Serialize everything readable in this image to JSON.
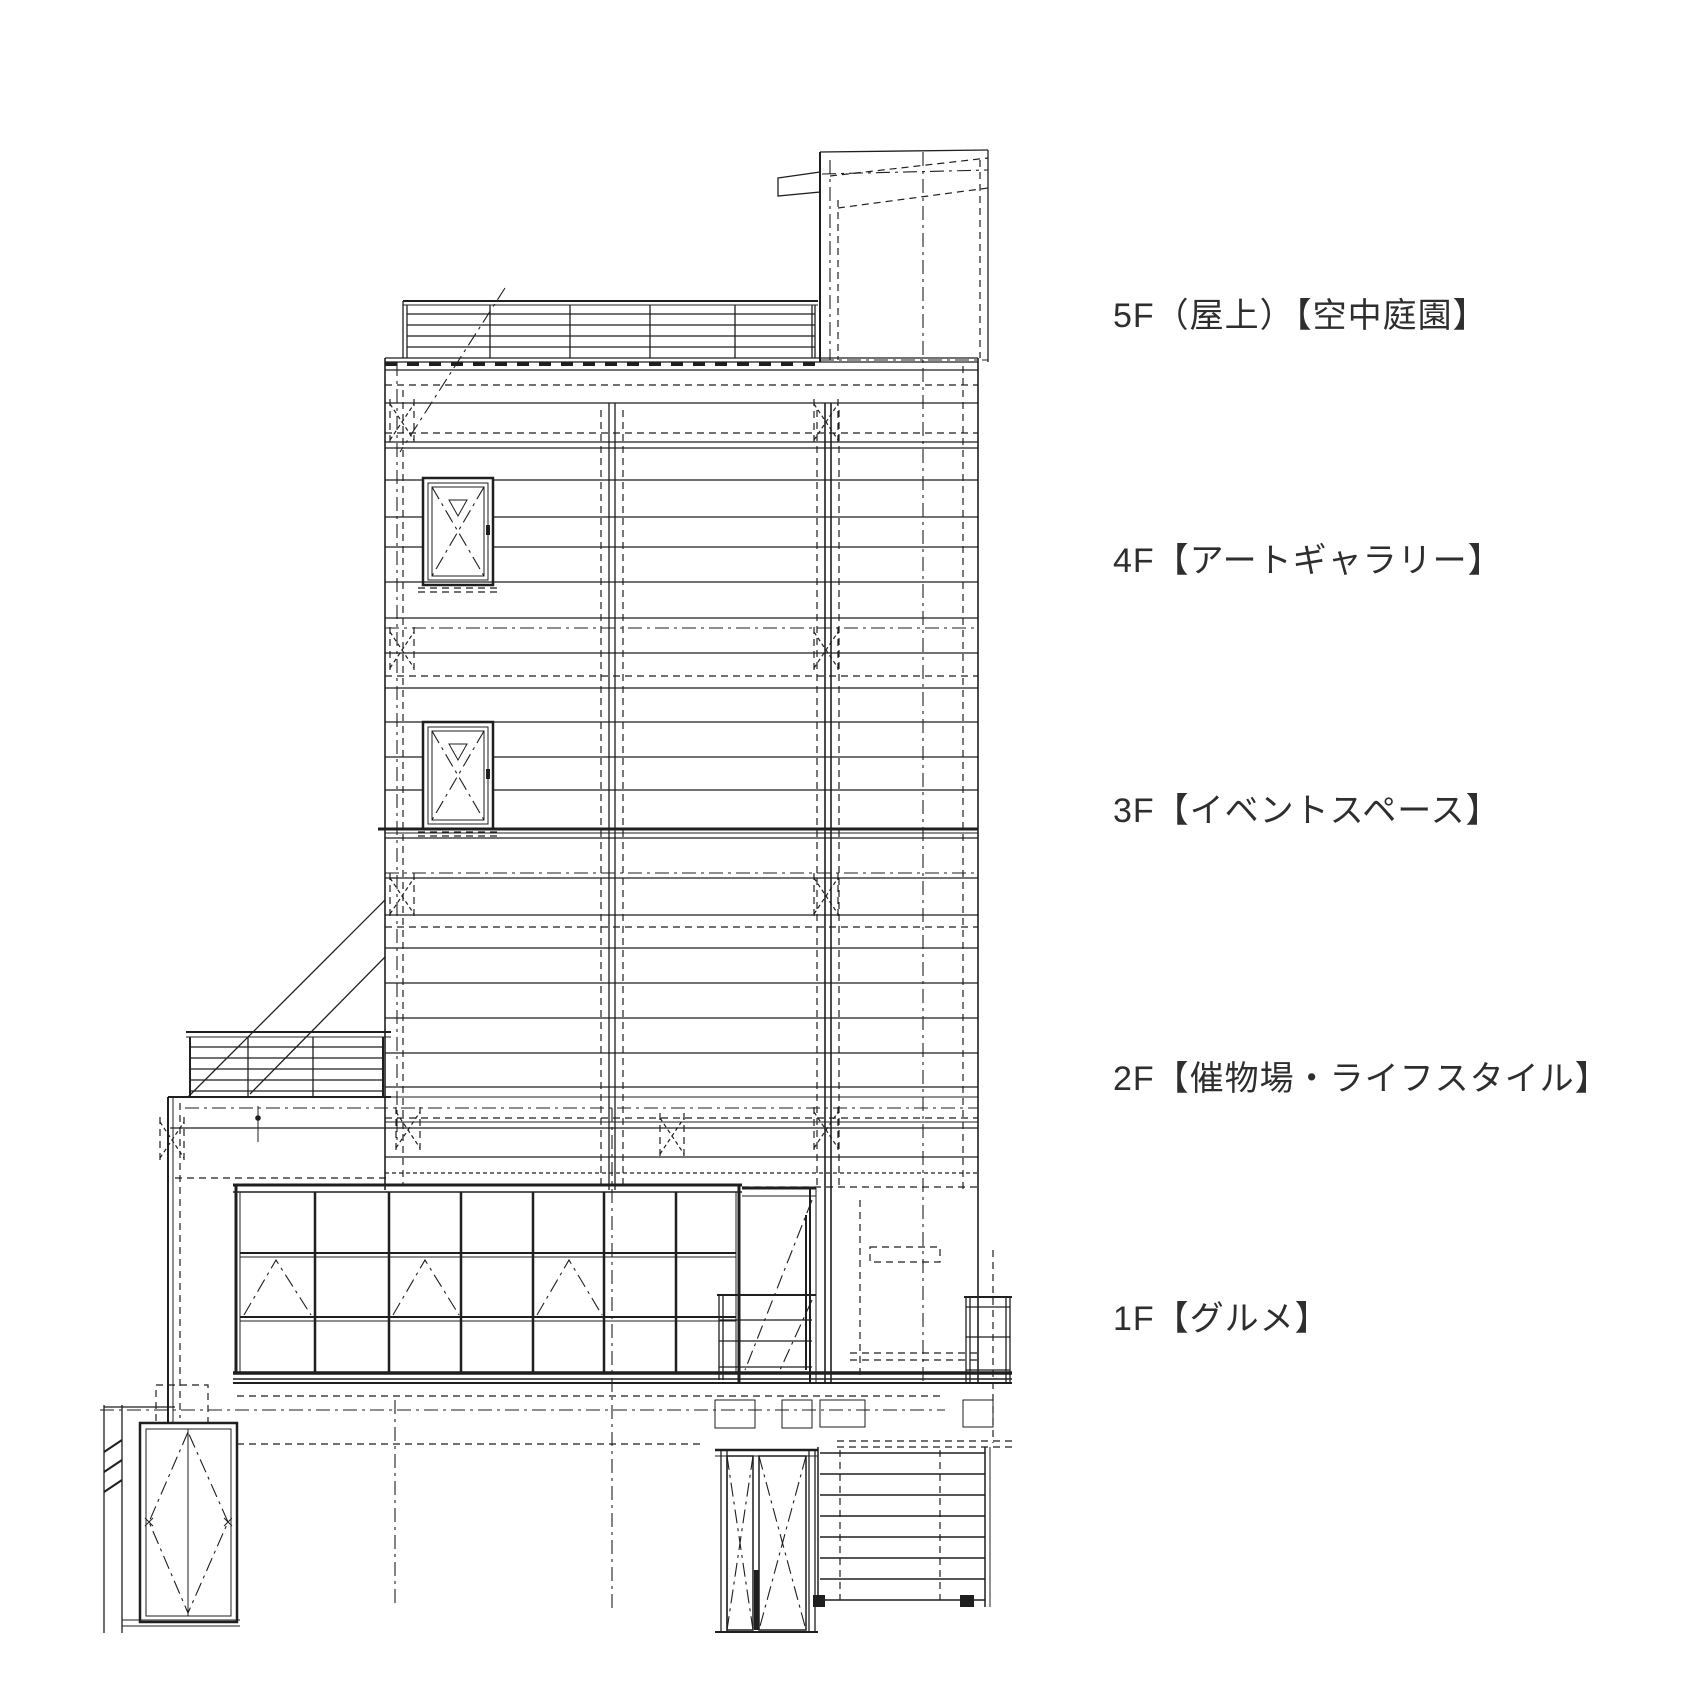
{
  "drawing": {
    "title": "建物立面図（フロア構成）",
    "type": "building-elevation",
    "line_color": "#1f1f1f",
    "background": "#ffffff",
    "floors": [
      {
        "level": "5F",
        "label": "5F（屋上）【空中庭園】",
        "zone": "空中庭園"
      },
      {
        "level": "4F",
        "label": "4F【アートギャラリー】",
        "zone": "アートギャラリー"
      },
      {
        "level": "3F",
        "label": "3F【イベントスペース】",
        "zone": "イベントスペース"
      },
      {
        "level": "2F",
        "label": "2F【催物場・ライフスタイル】",
        "zone": "催物場・ライフスタイル"
      },
      {
        "level": "1F",
        "label": "1F【グルメ】",
        "zone": "グルメ"
      }
    ]
  }
}
